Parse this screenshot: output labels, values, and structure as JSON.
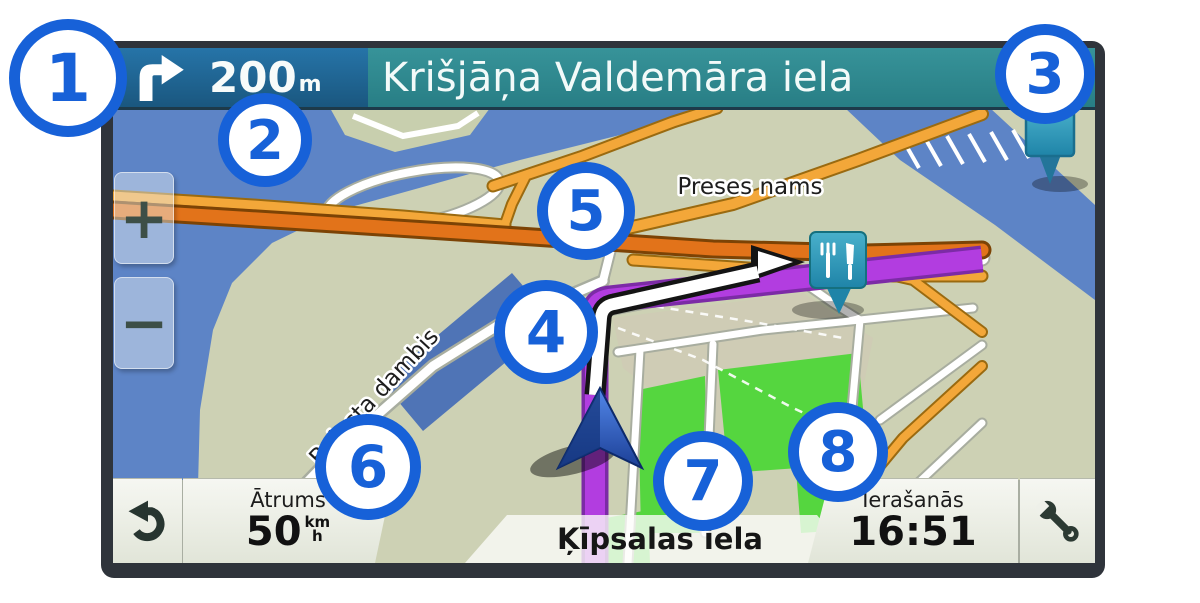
{
  "navigation": {
    "maneuver": {
      "icon": "turn-right",
      "distance_value": "200",
      "distance_unit": "m"
    },
    "next_maneuver_street": "Krišjāņa Valdemāra iela"
  },
  "map": {
    "labels": {
      "area": "Preses nams",
      "coast_road": "Balasta dambis"
    },
    "zoom_in": "+",
    "zoom_out": "−",
    "poi": {
      "type": "restaurant",
      "icon": "fork-knife-pin"
    },
    "destination_pin": "location-pin"
  },
  "status_bar": {
    "back_icon": "back-arrow",
    "speed": {
      "label": "Ātrums",
      "value": "50",
      "unit_top": "km",
      "unit_bottom": "h"
    },
    "current_street": "Ķīpsalas iela",
    "arrival": {
      "label": "Ierašanās",
      "time": "16:51"
    },
    "tools_icon": "wrench"
  },
  "callouts": [
    {
      "number": "1"
    },
    {
      "number": "2"
    },
    {
      "number": "3"
    },
    {
      "number": "4"
    },
    {
      "number": "5"
    },
    {
      "number": "6"
    },
    {
      "number": "7"
    },
    {
      "number": "8"
    }
  ],
  "colors": {
    "callout_blue": "#1761d8",
    "route_purple": "#b23de0",
    "top_bar_blue": "#1f6190",
    "street_sign_teal": "#2f8e92",
    "water_blue": "#5d84c6",
    "park_green": "#55d63f",
    "highway_orange": "#f3a739",
    "main_road_orange": "#e2731a",
    "poi_teal": "#2f9db0",
    "device_frame": "#2f343b"
  }
}
